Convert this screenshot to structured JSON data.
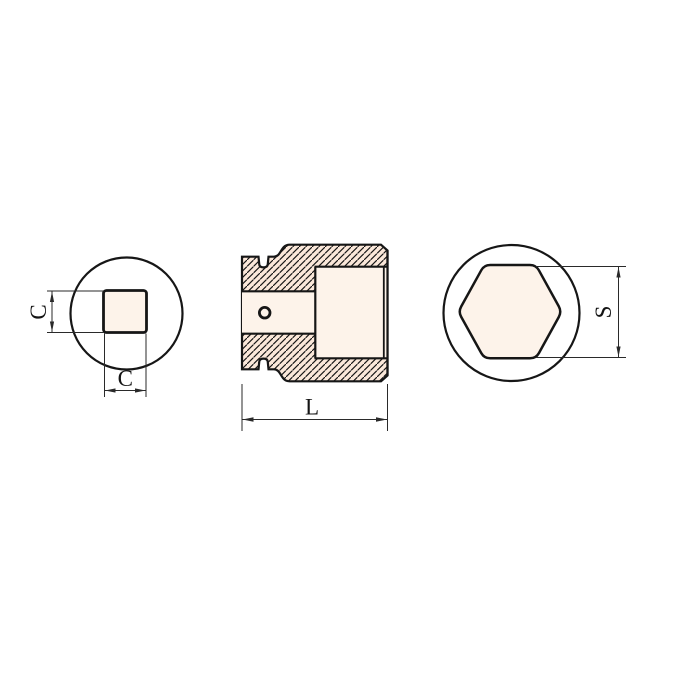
{
  "drawing": {
    "description": "Square-drive socket technical drawing, three views",
    "labels": {
      "drive_size_vertical": "C",
      "drive_size_horizontal": "C",
      "overall_length": "L",
      "across_flats": "S"
    },
    "colors": {
      "background": "#ffffff",
      "body_fill": "#fbe8da",
      "cavity_fill": "#fdf3ea",
      "outline": "#161616",
      "dimension_line": "#2a2a2a"
    }
  }
}
